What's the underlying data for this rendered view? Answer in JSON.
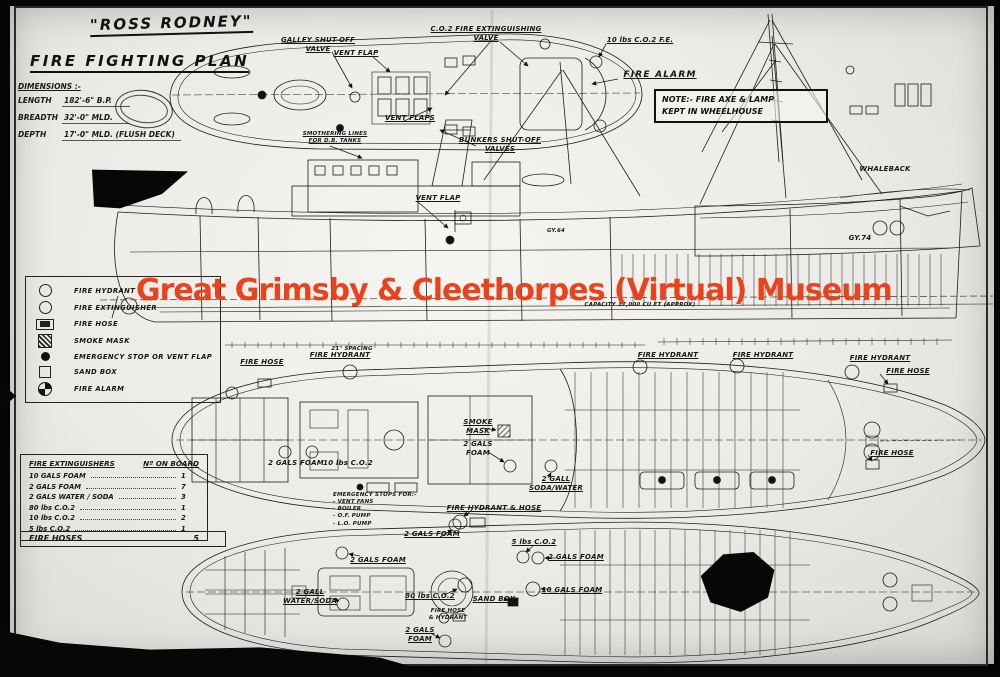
{
  "watermark": {
    "text": "Great Grimsby & Cleethorpes (Virtual) Museum",
    "color": "#e8431c"
  },
  "title_block": {
    "ship_name": "\"ROSS RODNEY\"",
    "plan_title": "FIRE FIGHTING PLAN"
  },
  "dimensions": {
    "heading": "DIMENSIONS :-",
    "rows": [
      {
        "label": "LENGTH",
        "value": "182'-6\" B.P."
      },
      {
        "label": "BREADTH",
        "value": "32'-0\" MLD."
      },
      {
        "label": "DEPTH",
        "value": "17'-0\" MLD. (FLUSH DECK)"
      }
    ]
  },
  "note_box": {
    "text": "NOTE:- FIRE AXE & LAMP\nKEPT IN WHEELHOUSE"
  },
  "legend": {
    "items": [
      {
        "symbol": "circle-outline",
        "label": "FIRE HYDRANT"
      },
      {
        "symbol": "circle-outline",
        "label": "FIRE EXTINGUISHER"
      },
      {
        "symbol": "hose-reel",
        "label": "FIRE HOSE"
      },
      {
        "symbol": "hatched-square",
        "label": "SMOKE MASK"
      },
      {
        "symbol": "filled-circle",
        "label": "EMERGENCY STOP OR VENT FLAP"
      },
      {
        "symbol": "square-outline",
        "label": "SAND BOX"
      },
      {
        "symbol": "quartered-circle",
        "label": "FIRE ALARM"
      }
    ]
  },
  "extinguisher_table": {
    "heading_left": "FIRE EXTINGUISHERS",
    "heading_right": "Nº ON BOARD",
    "rows": [
      {
        "label": "10 GALS FOAM",
        "value": "1"
      },
      {
        "label": "2 GALS FOAM",
        "value": "7"
      },
      {
        "label": "2 GALS WATER / SODA",
        "value": "3"
      },
      {
        "label": "80 lbs C.O.2",
        "value": "1"
      },
      {
        "label": "10 lbs C.O.2",
        "value": "2"
      },
      {
        "label": "5 lbs C.O.2",
        "value": "1"
      }
    ],
    "footer": {
      "label": "FIRE HOSES",
      "value": "5"
    }
  },
  "annotations": [
    {
      "text": "GALLEY SHUT-OFF\nVALVE"
    },
    {
      "text": "C.O.2 FIRE EXTINGUISHING\nVALVE"
    },
    {
      "text": "10 lbs C.O.2 F.E."
    },
    {
      "text": "FIRE ALARM"
    },
    {
      "text": "VENT FLAP"
    },
    {
      "text": "VENT FLAPS"
    },
    {
      "text": "BUNKERS SHUT-OFF\nVALVES"
    },
    {
      "text": "SMOTHERING LINES\nFOR D.B. TANKS"
    },
    {
      "text": "VENT FLAP"
    },
    {
      "text": "WHALEBACK"
    },
    {
      "text": "GY.74"
    },
    {
      "text": "GY.64"
    },
    {
      "text": "CAPACITY  17,000  CU FT (APPROX)"
    },
    {
      "text": "21\" SPACING"
    },
    {
      "text": "FIRE HOSE"
    },
    {
      "text": "FIRE HYDRANT"
    },
    {
      "text": "FIRE HYDRANT"
    },
    {
      "text": "FIRE HYDRANT"
    },
    {
      "text": "FIRE HYDRANT"
    },
    {
      "text": "FIRE HOSE"
    },
    {
      "text": "FIRE HOSE"
    },
    {
      "text": "SMOKE\nMASK"
    },
    {
      "text": "2 GALS\nFOAM"
    },
    {
      "text": "2 GALS FOAM"
    },
    {
      "text": "10 lbs C.O.2"
    },
    {
      "text": "2 GALL\nSODA/WATER"
    },
    {
      "text": "EMERGENCY STOPS FOR:-\n- VENT FANS\n- BOILER\n- O.F. PUMP\n- L.O. PUMP"
    },
    {
      "text": "FIRE HYDRANT & HOSE"
    },
    {
      "text": "2 GALS FOAM"
    },
    {
      "text": "5 lbs C.O.2"
    },
    {
      "text": "2 GALS FOAM"
    },
    {
      "text": "2 GALS FOAM"
    },
    {
      "text": "80 lbs C.O.2"
    },
    {
      "text": "SAND BOX"
    },
    {
      "text": "10 GALS FOAM"
    },
    {
      "text": "2 GALL\nWATER/SODA"
    },
    {
      "text": "FIRE HOSE\n& HYDRANT"
    },
    {
      "text": "2 GALS\nFOAM"
    }
  ]
}
